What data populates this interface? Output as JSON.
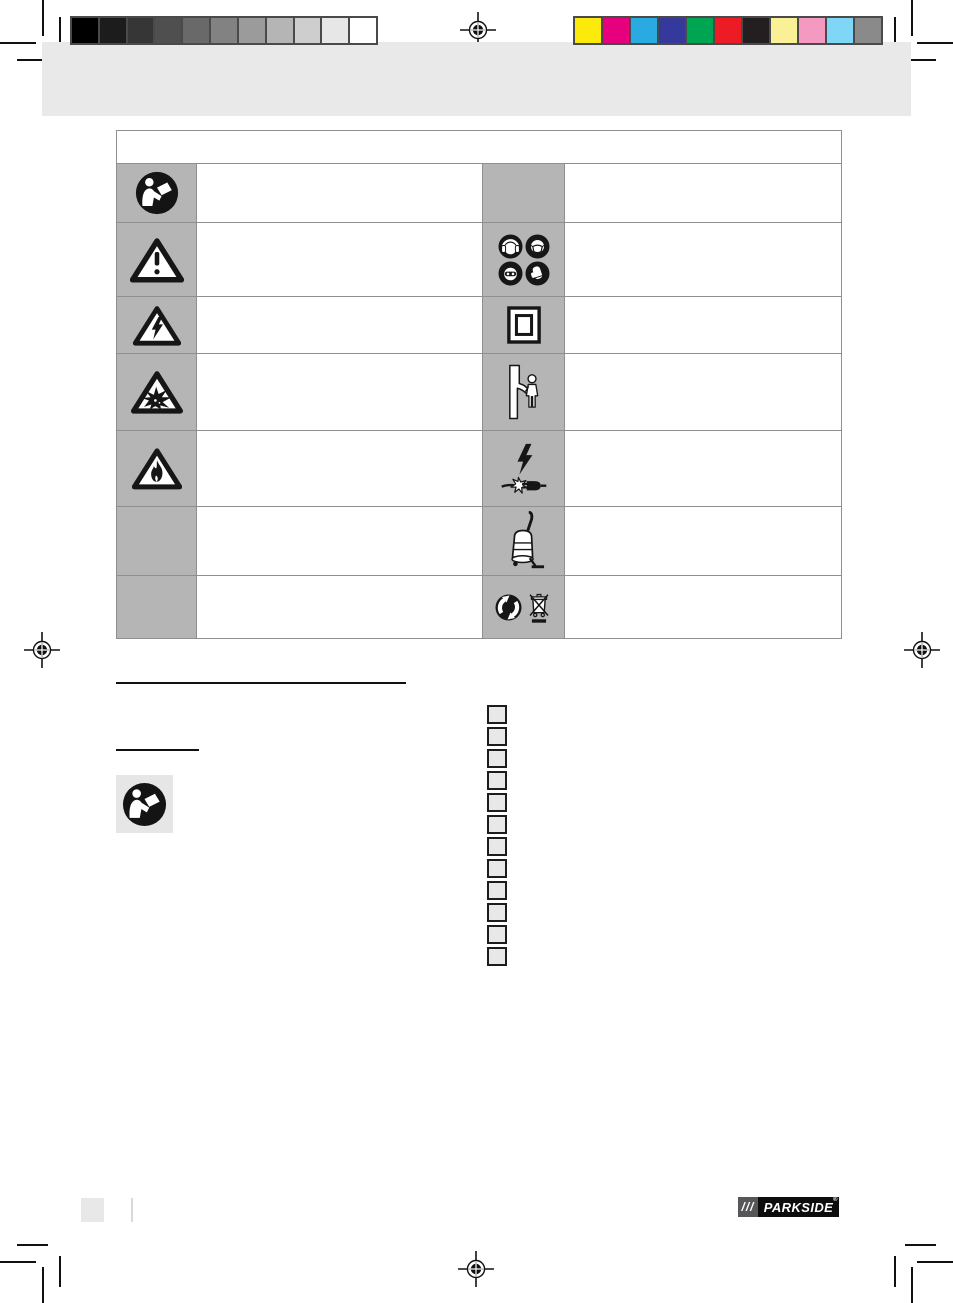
{
  "page": {
    "kind": "prepress-manual-page",
    "background": "#ffffff",
    "band_color": "#e9e9e9"
  },
  "prepress": {
    "grayscale_bar": [
      "#000000",
      "#1c1c1c",
      "#363636",
      "#4f4f4f",
      "#696969",
      "#828282",
      "#9b9b9b",
      "#b5b5b5",
      "#cecece",
      "#e7e7e7",
      "#ffffff"
    ],
    "color_bar": [
      "#fcea0d",
      "#e6007e",
      "#29abe2",
      "#34399b",
      "#00a551",
      "#ec1b24",
      "#231f20",
      "#faf095",
      "#f49ac1",
      "#7fd6f7",
      "#8a8a8a"
    ],
    "registration_mark_count": 4
  },
  "symbols_table": {
    "header_text": "",
    "symbol_cell_color": "#b5b5b5",
    "border_color": "#8f8f8f",
    "rows": [
      {
        "left_icon": "read-manual-icon",
        "left_text": "",
        "right_icon": "",
        "right_text": ""
      },
      {
        "left_icon": "general-warning-icon",
        "left_text": "",
        "right_icon": "ppe-protection-icons",
        "right_text": ""
      },
      {
        "left_icon": "electric-shock-warning-icon",
        "left_text": "",
        "right_icon": "double-insulation-icon",
        "right_text": ""
      },
      {
        "left_icon": "explosion-warning-icon",
        "left_text": "",
        "right_icon": "keep-children-away-icon",
        "right_text": ""
      },
      {
        "left_icon": "fire-warning-icon",
        "left_text": "",
        "right_icon": "damaged-power-cable-icon",
        "right_text": ""
      },
      {
        "left_icon": "",
        "left_text": "",
        "right_icon": "vacuum-cleaner-icon",
        "right_text": ""
      },
      {
        "left_icon": "",
        "left_text": "",
        "right_icon": "recycling-and-weee-disposal-icons",
        "right_text": ""
      }
    ]
  },
  "content": {
    "section_title_text": "",
    "subheading_text": "",
    "read_manual_icon": "read-manual-icon",
    "checkbox_count": 12
  },
  "footer": {
    "page_number": "",
    "brand_slashes": "///",
    "brand_name": "PARKSIDE",
    "brand_reg": "®"
  }
}
